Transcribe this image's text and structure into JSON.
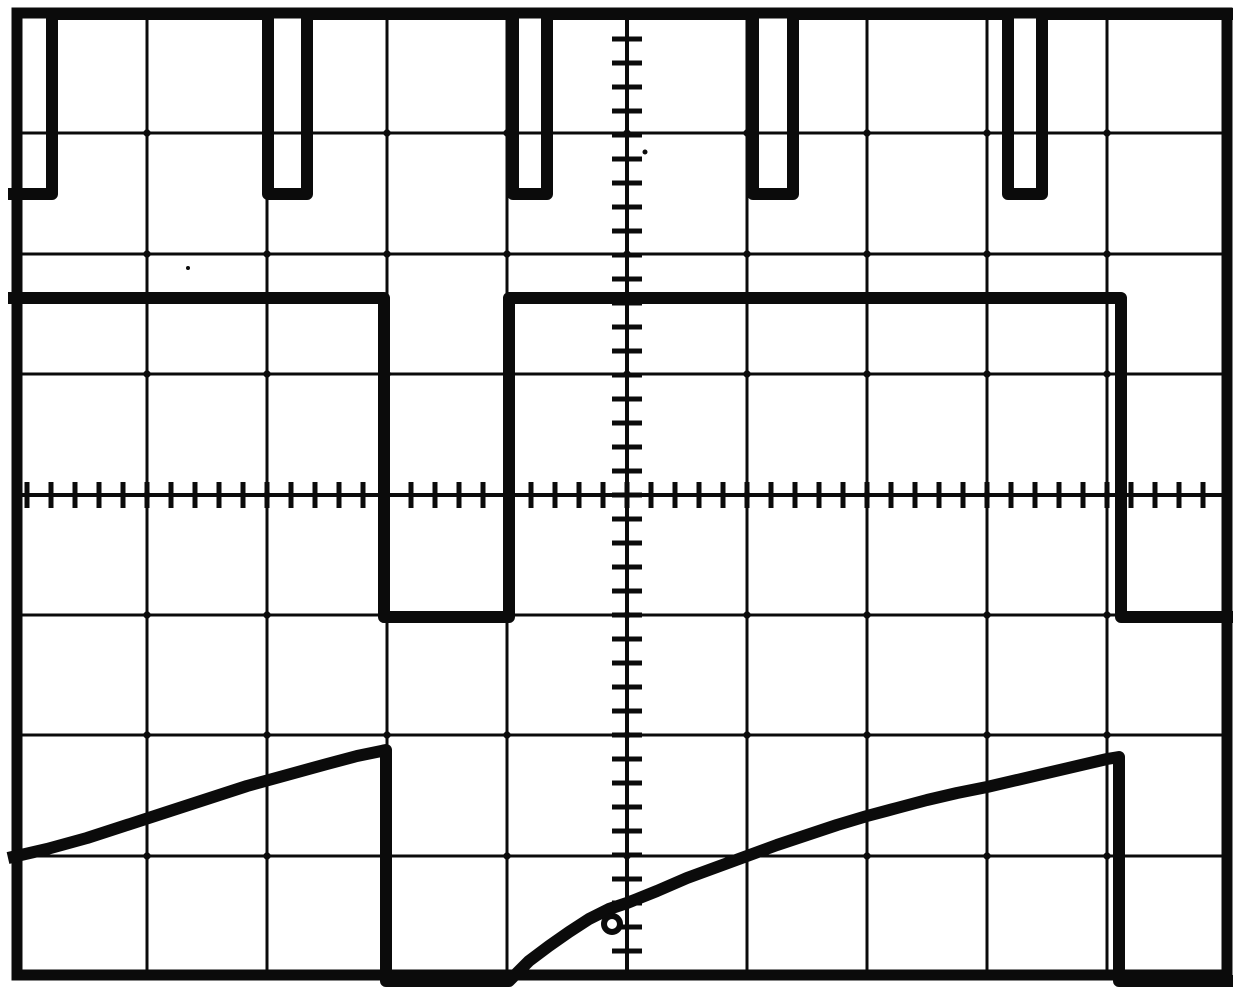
{
  "canvas": {
    "width": 1241,
    "height": 1005,
    "background": "#ffffff",
    "ink": "#0b0b0b"
  },
  "graticule": {
    "border": {
      "x": 17,
      "y": 13,
      "width": 1210,
      "height": 962,
      "stroke_width": 11
    },
    "divisions": {
      "cols": 10,
      "rows": 8,
      "px_per_div_x": 121,
      "px_per_div_y": 120
    },
    "v_gridlines": [
      147,
      267,
      387,
      507,
      747,
      867,
      987,
      1107
    ],
    "h_gridlines": [
      133,
      254,
      374,
      615,
      735,
      856
    ],
    "gridline_width": 3,
    "center_axes": {
      "x": 627,
      "y": 495,
      "width": 4
    },
    "ticks": {
      "h_axis": {
        "y": 495,
        "x_start": 27,
        "x_end": 1227,
        "step": 24,
        "length": 26,
        "width": 5
      },
      "v_axis": {
        "x": 627,
        "y_start": 15,
        "y_end": 975,
        "step": 24,
        "length": 30,
        "width": 5
      }
    },
    "junction_dot_half": 5
  },
  "traces": {
    "stroke_width": 12,
    "pulse_train": {
      "points": [
        [
          8,
          194
        ],
        [
          52,
          194
        ],
        [
          52,
          14
        ],
        [
          268,
          14
        ],
        [
          268,
          194
        ],
        [
          307,
          194
        ],
        [
          307,
          14
        ],
        [
          513,
          14
        ],
        [
          513,
          194
        ],
        [
          547,
          194
        ],
        [
          547,
          14
        ],
        [
          753,
          14
        ],
        [
          753,
          194
        ],
        [
          793,
          194
        ],
        [
          793,
          14
        ],
        [
          1008,
          14
        ],
        [
          1008,
          194
        ],
        [
          1042,
          194
        ],
        [
          1042,
          14
        ],
        [
          1233,
          14
        ]
      ]
    },
    "square_wave": {
      "points": [
        [
          8,
          298
        ],
        [
          384,
          298
        ],
        [
          384,
          617
        ],
        [
          509,
          617
        ],
        [
          509,
          298
        ],
        [
          1121,
          298
        ],
        [
          1121,
          617
        ],
        [
          1233,
          617
        ]
      ]
    },
    "exp_ramp": {
      "points": [
        [
          8,
          858
        ],
        [
          47,
          849
        ],
        [
          87,
          838
        ],
        [
          127,
          825
        ],
        [
          167,
          812
        ],
        [
          207,
          799
        ],
        [
          247,
          786
        ],
        [
          287,
          775
        ],
        [
          327,
          764
        ],
        [
          357,
          756
        ],
        [
          386,
          750
        ],
        [
          386,
          981
        ],
        [
          509,
          981
        ],
        [
          529,
          961
        ],
        [
          549,
          946
        ],
        [
          569,
          932
        ],
        [
          589,
          919
        ],
        [
          609,
          909
        ],
        [
          627,
          903
        ],
        [
          657,
          891
        ],
        [
          687,
          878
        ],
        [
          717,
          867
        ],
        [
          747,
          856
        ],
        [
          777,
          845
        ],
        [
          807,
          835
        ],
        [
          837,
          825
        ],
        [
          867,
          816
        ],
        [
          897,
          808
        ],
        [
          927,
          800
        ],
        [
          957,
          793
        ],
        [
          987,
          787
        ],
        [
          1017,
          780
        ],
        [
          1047,
          773
        ],
        [
          1077,
          766
        ],
        [
          1107,
          759
        ],
        [
          1119,
          757
        ],
        [
          1119,
          981
        ],
        [
          1233,
          981
        ]
      ]
    }
  },
  "artifacts": {
    "loop": {
      "cx": 612,
      "cy": 924,
      "r": 8,
      "stroke_width": 6
    },
    "specks": [
      [
        645,
        152,
        2.5
      ],
      [
        188,
        268,
        2
      ]
    ]
  },
  "chart_data": {
    "type": "line",
    "title": "Oscilloscope screen: pulse train, gated square wave, exponential charging ramp",
    "x_axis": {
      "label": "time (divisions)",
      "range": [
        -5,
        5
      ],
      "minor_per_div": 5,
      "grid": true
    },
    "y_axis": {
      "label": "amplitude (divisions)",
      "range": [
        -4,
        4
      ],
      "minor_per_div": 5,
      "grid": true
    },
    "legend": false,
    "series": [
      {
        "name": "pulse-train",
        "description": "Narrow negative-going pulses from top graticule line, ~0.3 div wide, 1.5 div deep, ~2 div period",
        "points": [
          [
            -5.16,
            2.51
          ],
          [
            -4.79,
            2.51
          ],
          [
            -4.79,
            4.01
          ],
          [
            -2.99,
            4.01
          ],
          [
            -2.99,
            2.51
          ],
          [
            -2.67,
            2.51
          ],
          [
            -2.67,
            4.01
          ],
          [
            -0.95,
            4.01
          ],
          [
            -0.95,
            2.51
          ],
          [
            -0.67,
            2.51
          ],
          [
            -0.67,
            4.01
          ],
          [
            1.05,
            4.01
          ],
          [
            1.05,
            2.51
          ],
          [
            1.38,
            2.51
          ],
          [
            1.38,
            4.01
          ],
          [
            3.18,
            4.01
          ],
          [
            3.18,
            2.51
          ],
          [
            3.46,
            2.51
          ],
          [
            3.46,
            4.01
          ],
          [
            5.05,
            4.01
          ]
        ]
      },
      {
        "name": "square-wave",
        "description": "Gate waveform: high 1.64 div, low -1.02 div; falls at -2.03 div, rises at -0.98 div, falls again at 4.12 div",
        "points": [
          [
            -5.16,
            1.64
          ],
          [
            -2.03,
            1.64
          ],
          [
            -2.03,
            -1.02
          ],
          [
            -0.98,
            -1.02
          ],
          [
            -0.98,
            1.64
          ],
          [
            4.12,
            1.64
          ],
          [
            4.12,
            -1.02
          ],
          [
            5.05,
            -1.02
          ]
        ]
      },
      {
        "name": "exponential-ramp",
        "description": "Exponential charging sawtooth along bottom graticule line, resets where the gate falls",
        "points": [
          [
            -5.16,
            -3.03
          ],
          [
            -4.17,
            -2.75
          ],
          [
            -3.17,
            -2.43
          ],
          [
            -2.01,
            -2.13
          ],
          [
            -2.01,
            -4.05
          ],
          [
            -0.98,
            -4.05
          ],
          [
            0.0,
            -3.4
          ],
          [
            1.0,
            -3.01
          ],
          [
            2.0,
            -2.68
          ],
          [
            3.0,
            -2.43
          ],
          [
            4.0,
            -2.2
          ],
          [
            4.1,
            -2.18
          ],
          [
            4.1,
            -4.05
          ],
          [
            5.05,
            -4.05
          ]
        ]
      }
    ]
  }
}
